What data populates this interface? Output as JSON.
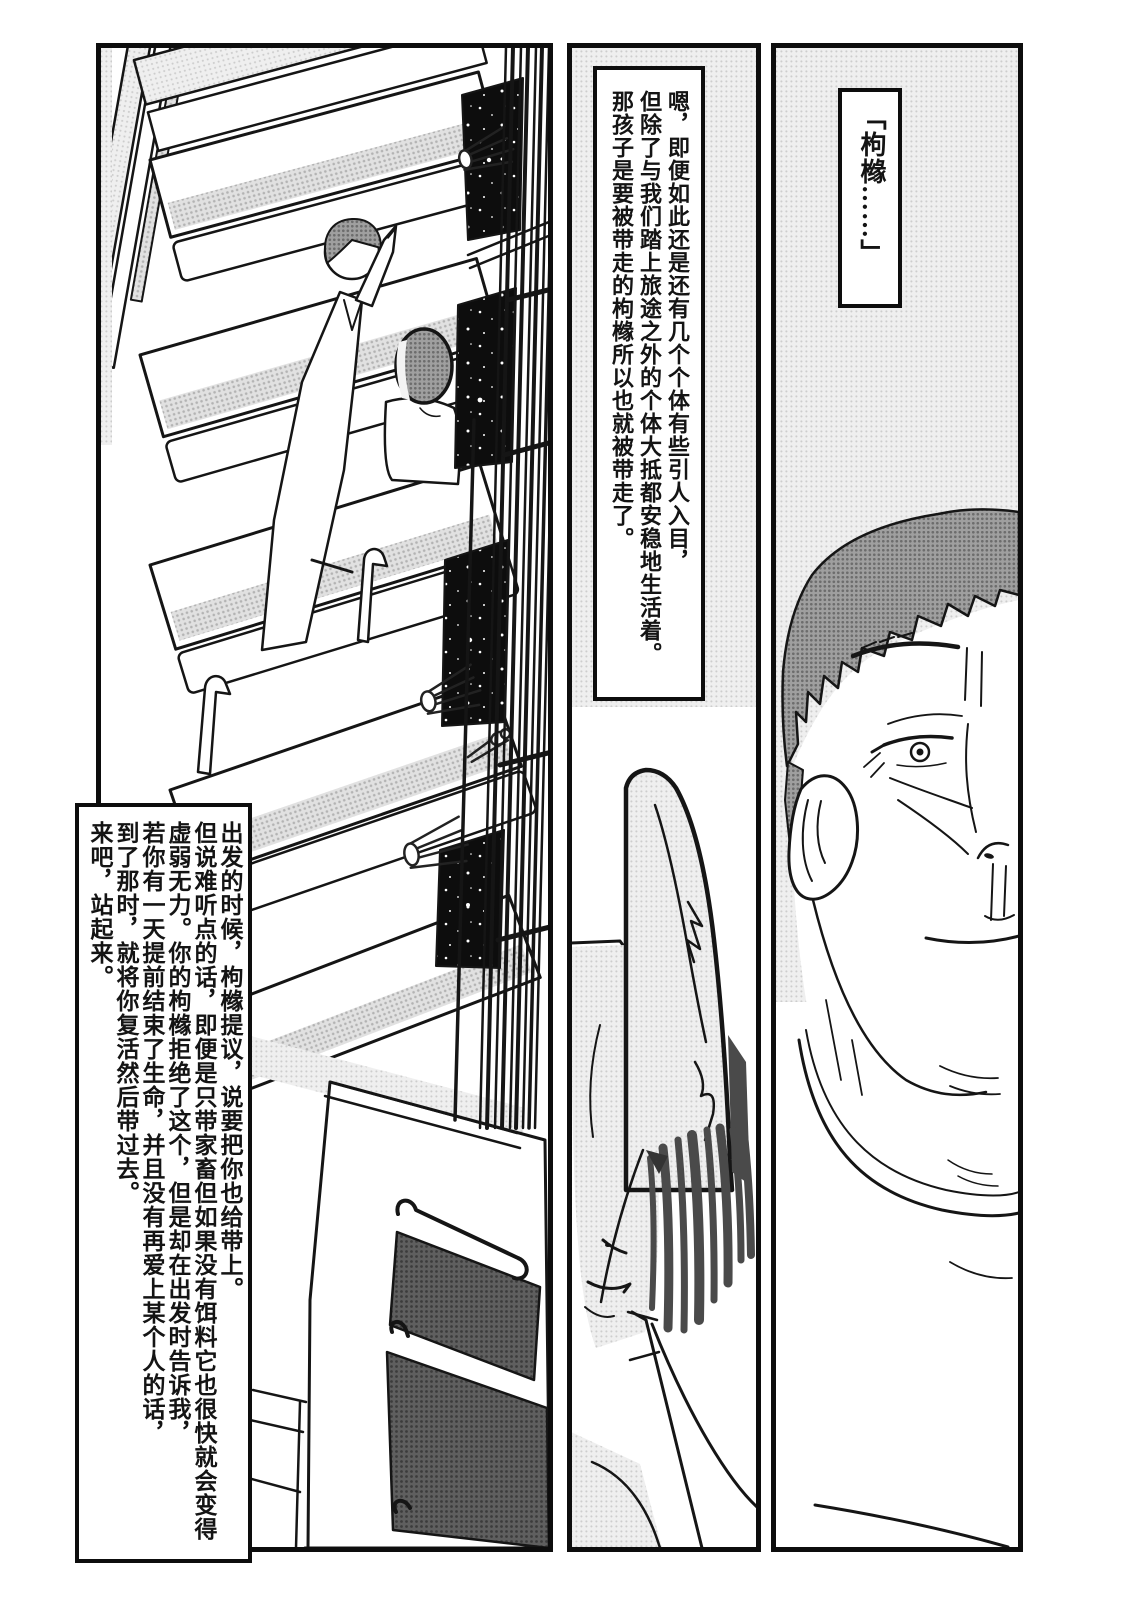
{
  "page": {
    "kind": "manga-page",
    "background": "#ffffff",
    "ink": "#111111"
  },
  "colors": {
    "halftone_light": "#ebebeb",
    "halftone_mid": "#d9d9d9",
    "hair_gray": "#8d8d8d",
    "starfield": "#0d0d0d",
    "panel_border": "#0d0d0d"
  },
  "panels": {
    "left": {
      "alt": "tilted interior scene: rows of bench seats, starry windows behind bars, a standing robed figure and a seated dark-haired figure, cabinets below",
      "narration_columns": [
        "出发的时候，枸橼提议，说要把你也给带上。",
        "但说难听点的话，即便是只带家畜但如果没有饵料它也很快就会变得",
        "虚弱无力。你的枸橼拒绝了这个，但是却在出发时告诉我，",
        "若你有一天提前结束了生命，并且没有再爱上某个人的话，",
        "到了那时，就将你复活然后带过去。",
        "来吧，站起来。"
      ]
    },
    "middle": {
      "alt": "narration box above a long-eared creature with hanging hair strands, smiling, wearing a robe",
      "narration_columns": [
        "嗯，即便如此还是还有几个个体有些引人入目，",
        "但除了与我们踏上旅途之外的个体大抵都安稳地生活着。",
        "那孩子是要被带走的枸橼所以也就被带走了。"
      ]
    },
    "right": {
      "alt": "close-up of a middle-aged man's half face with short dark hair, white shirt",
      "dialogue": "「枸橼……」"
    }
  }
}
